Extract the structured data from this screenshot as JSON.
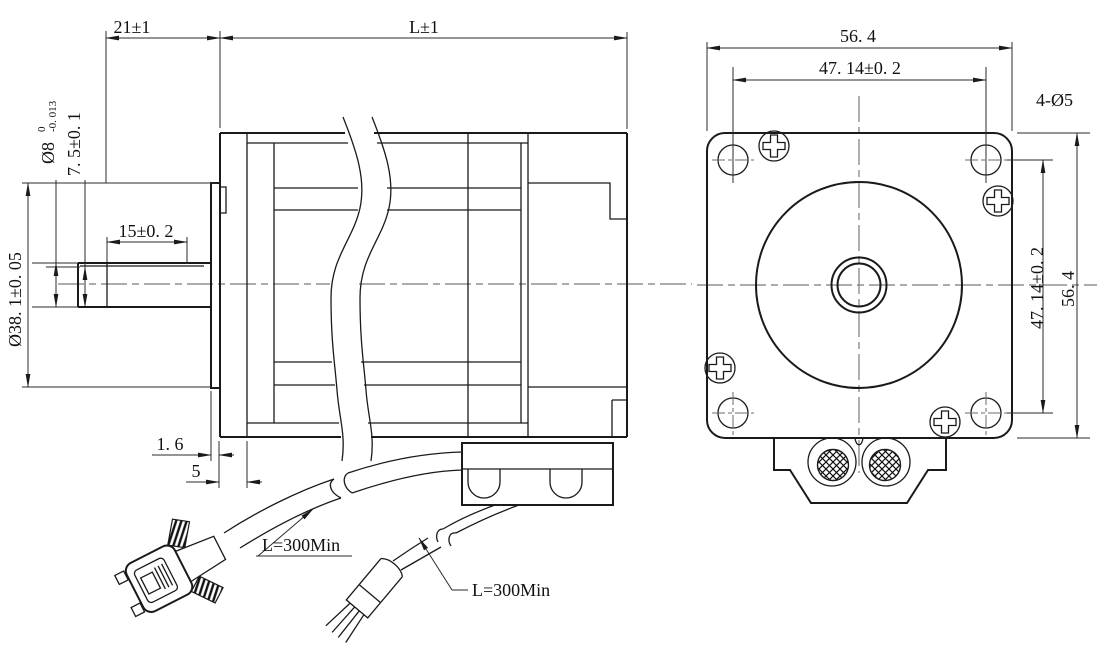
{
  "drawing": {
    "type": "stepper-motor-dimension-drawing",
    "background": "#ffffff",
    "line_color": "#1a1a1a",
    "centerline_color": "#7a7a7a"
  },
  "side_view": {
    "dims": {
      "front_length": "21±1",
      "body_length": "L±1",
      "shaft_dia": "Ø8",
      "shaft_tol_upper": "0",
      "shaft_tol_lower": "-0. 013",
      "flat_height": "7. 5±0. 1",
      "flat_length": "15±0. 2",
      "pilot_dia": "Ø38. 1±0. 05",
      "boss_thickness": "1. 6",
      "boss_depth": "5"
    },
    "cables": {
      "db9_cable_length": "L=300Min",
      "lead_cable_length": "L=300Min"
    }
  },
  "front_view": {
    "dims": {
      "frame_width": "56. 4",
      "hole_pitch_horizontal": "47. 14±0. 2",
      "hole_pitch_vertical": "47. 14±0. 2",
      "frame_height": "56. 4",
      "mounting_holes": "4-Ø5"
    }
  }
}
